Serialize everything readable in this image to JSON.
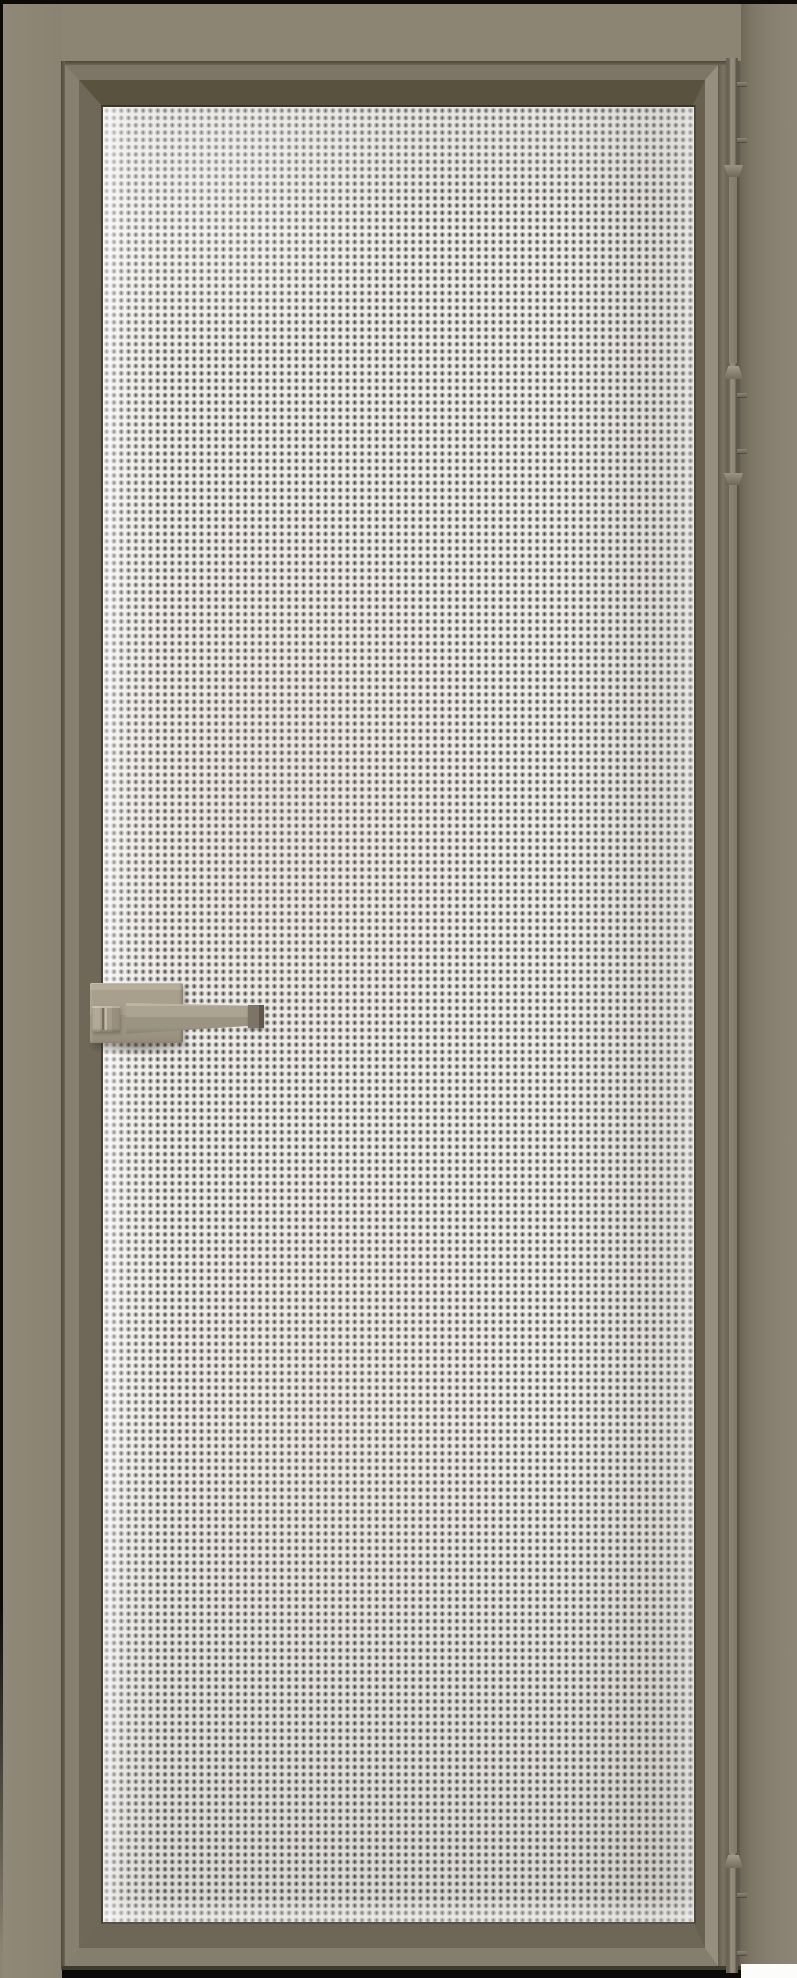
{
  "meta": {
    "subject": "Closed interior door with taupe aluminum frame and prismatic textured privacy glass, lever handle on the left, three concealed hinges on the right"
  },
  "theme": {
    "wall": "#8d8574",
    "frame-face": "#877f6f",
    "frame-face-light": "#968f7f",
    "frame-bevel-dark": "#59523f",
    "gap-line": "#4c473a",
    "glass-base": "#efeeec",
    "glass-dot": "#9b9894",
    "glass-tick": "#42403d",
    "glass-highlight": "#f5f4f2",
    "handle-face": "#a89f8d",
    "handle-top": "#b6ad9b",
    "handle-end-dark": "#5d574c",
    "hinge-face": "#968f80",
    "hinge-shadow": "#5f594d",
    "edge-black": "#0b0a09",
    "floor-white": "#fcfcfb"
  },
  "door": {
    "state": "closed",
    "glass_pattern": "prismatic diamond texture, ~7px cells, silver-gray with white sparkle",
    "handle": {
      "type": "square lever handle on rectangular backplate with thumbturn",
      "side": "left",
      "finish": "matte taupe metal"
    },
    "hinges": [
      {
        "label": "top hinge",
        "side": "right"
      },
      {
        "label": "upper-middle hinge",
        "side": "right"
      },
      {
        "label": "bottom hinge",
        "side": "right"
      }
    ],
    "frame_finish": "matte taupe / stone beige"
  }
}
